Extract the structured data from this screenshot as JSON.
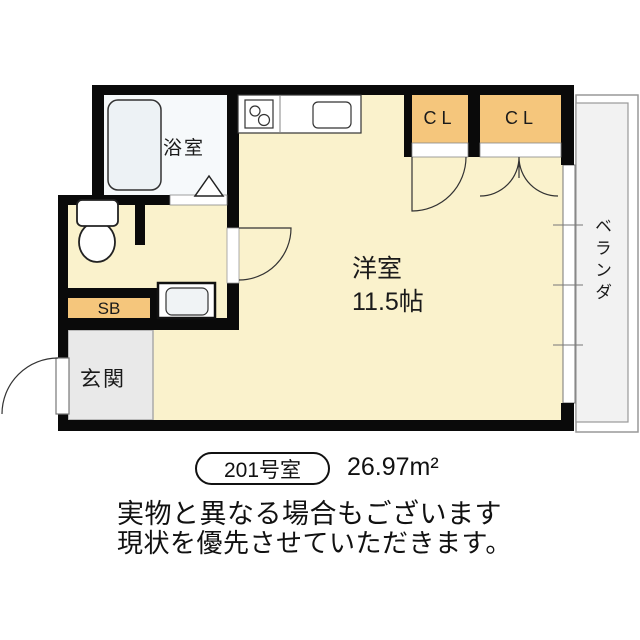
{
  "floor_plan": {
    "rooms": {
      "bathroom": {
        "label": "浴室"
      },
      "western_room": {
        "label": "洋室",
        "size": "11.5帖"
      },
      "closet1": {
        "label": "CL"
      },
      "closet2": {
        "label": "CL"
      },
      "shoe_box": {
        "label": "SB"
      },
      "entrance": {
        "label": "玄関"
      },
      "balcony": {
        "label": "ベランダ"
      }
    },
    "fixtures": [
      "bathtub",
      "toilet",
      "kitchen-stove",
      "kitchen-sink",
      "washing-machine-pan",
      "bath-door-triangle"
    ],
    "colors": {
      "room_fill": "#FAF2CC",
      "closet_fill": "#F5C67C",
      "entrance_fill": "#E9E9E9",
      "balcony_fill": "#F2F2F2",
      "bath_fill": "#F6F9FB",
      "wall": "#0A0A0A"
    }
  },
  "caption": {
    "room_number": "201号室",
    "area": "26.97m²",
    "note_line1": "実物と異なる場合もございます",
    "note_line2": "現状を優先させていただきます。"
  }
}
